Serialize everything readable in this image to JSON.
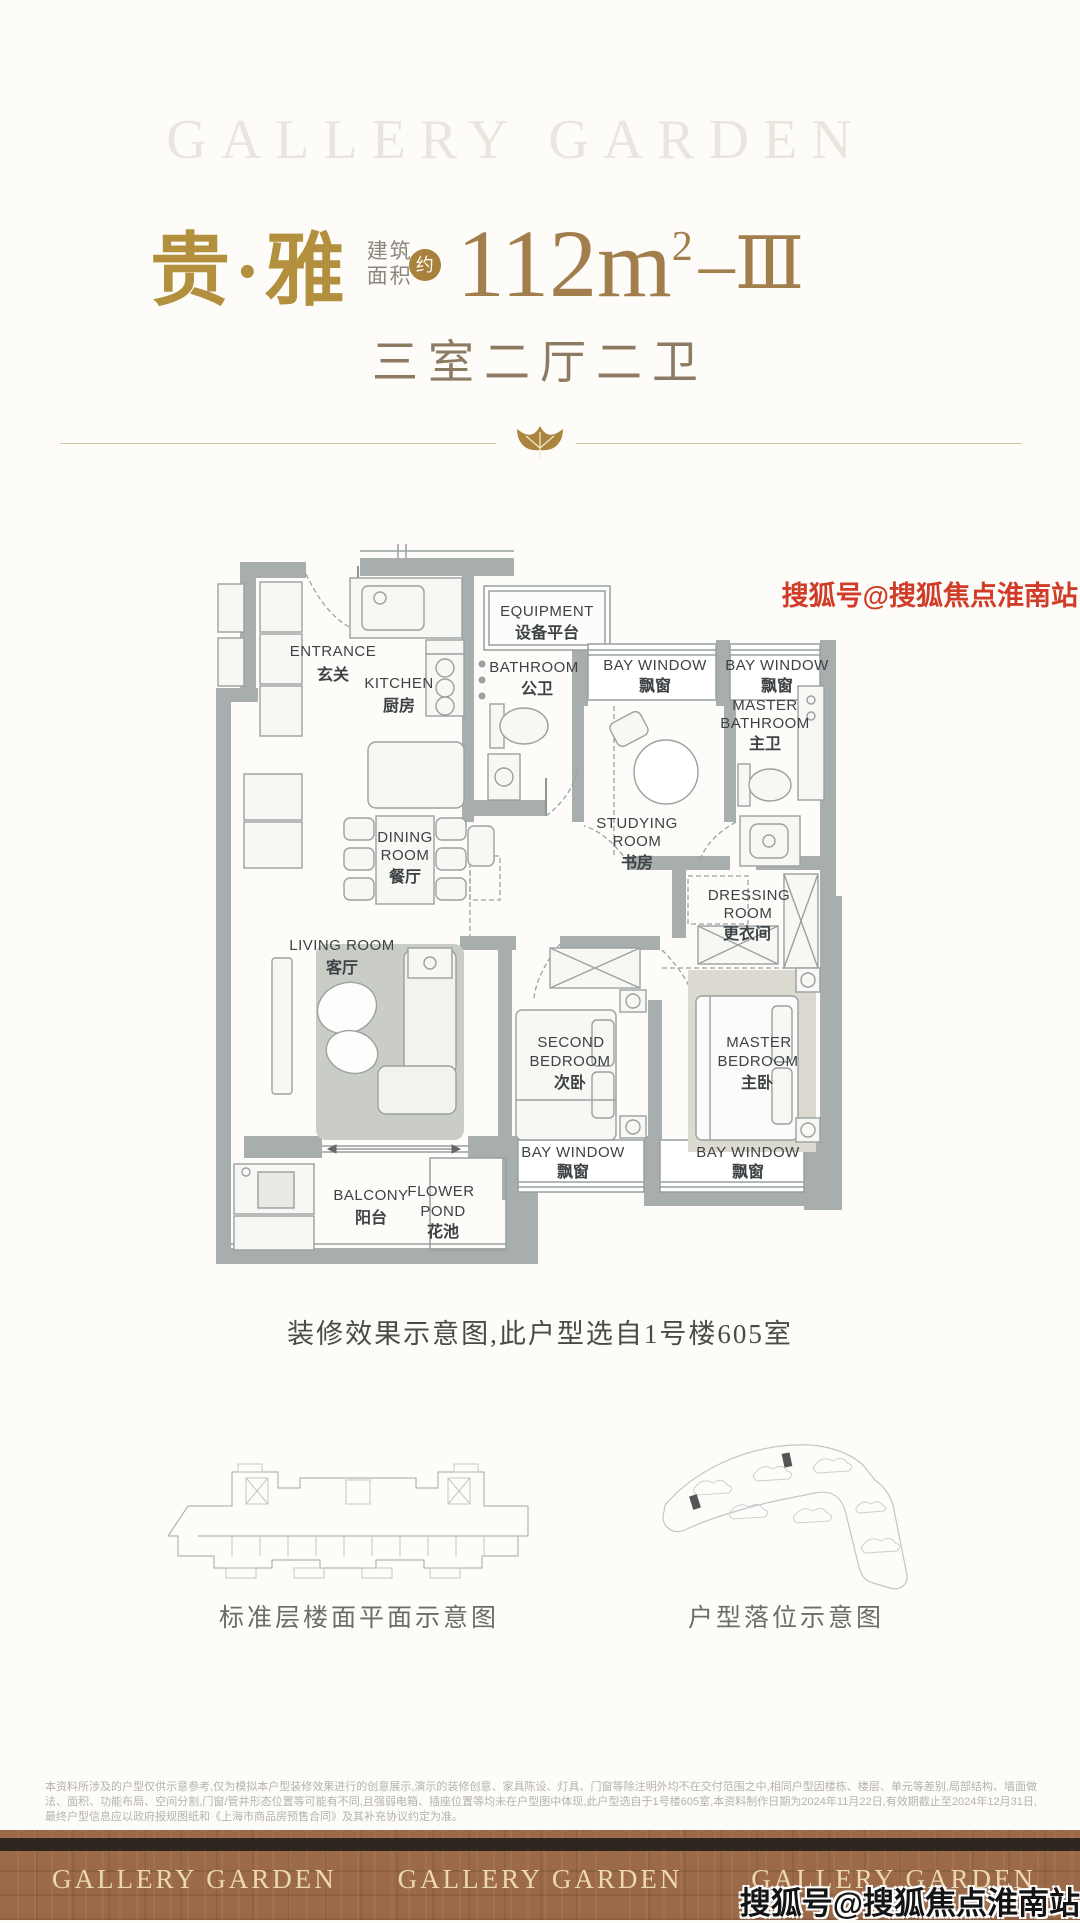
{
  "header": {
    "brand_watermark": "GALLERY GARDEN",
    "title": "贵·雅",
    "area_label_line1": "建筑",
    "area_label_line2": "面积",
    "area_badge": "约",
    "area_value": "112m",
    "area_sup": "2",
    "area_suffix": "–Ⅲ",
    "layout_spec": "三室二厅二卫"
  },
  "plan": {
    "entrance_en": "ENTRANCE",
    "entrance_cn": "玄关",
    "kitchen_en": "KITCHEN",
    "kitchen_cn": "厨房",
    "equipment_en": "EQUIPMENT",
    "equipment_cn": "设备平台",
    "bathroom_en": "BATHROOM",
    "bathroom_cn": "公卫",
    "bay_window_en": "BAY WINDOW",
    "bay_window_cn": "飘窗",
    "master_bath_en1": "MASTER",
    "master_bath_en2": "BATHROOM",
    "master_bath_cn": "主卫",
    "studying_en1": "STUDYING",
    "studying_en2": "ROOM",
    "studying_cn": "书房",
    "dining_en1": "DINING",
    "dining_en2": "ROOM",
    "dining_cn": "餐厅",
    "dressing_en1": "DRESSING",
    "dressing_en2": "ROOM",
    "dressing_cn": "更衣间",
    "living_en": "LIVING ROOM",
    "living_cn": "客厅",
    "second_bed_en1": "SECOND",
    "second_bed_en2": "BEDROOM",
    "second_bed_cn": "次卧",
    "master_bed_en1": "MASTER",
    "master_bed_en2": "BEDROOM",
    "master_bed_cn": "主卧",
    "balcony_en": "BALCONY",
    "balcony_cn": "阳台",
    "flower_en1": "FLOWER",
    "flower_en2": "POND",
    "flower_cn": "花池"
  },
  "captions": {
    "plan_note": "装修效果示意图,此户型选自1号楼605室",
    "left_diagram": "标准层楼面平面示意图",
    "right_diagram": "户型落位示意图"
  },
  "disclaimer": {
    "text": "本资料所涉及的户型仅供示意参考,仅为模拟本户型装修效果进行的创意展示,演示的装修创意、家具陈设、灯具、门窗等除注明外均不在交付范围之中,相同户型因楼栋、楼层、单元等差别,局部结构、墙面做法、面积、功能布局、空间分割,门窗/管井形态位置等可能有不同,且强弱电箱、插座位置等均未在户型图中体现,此户型选自于1号楼605室,本资料制作日期为2024年11月22日,有效期截止至2024年12月31日,最终户型信息应以政府报规图纸和《上海市商品房预售合同》及其补充协议约定为准。"
  },
  "footer": {
    "brand": "GALLERY GARDEN"
  },
  "watermark": {
    "text": "搜狐号@搜狐焦点淮南站"
  },
  "colors": {
    "gold": "#b2903e",
    "area_brown": "#a37e4d",
    "wall_gray": "#a8adad",
    "footer_brown": "#9c6a49",
    "watermark_red": "#d03c28"
  }
}
